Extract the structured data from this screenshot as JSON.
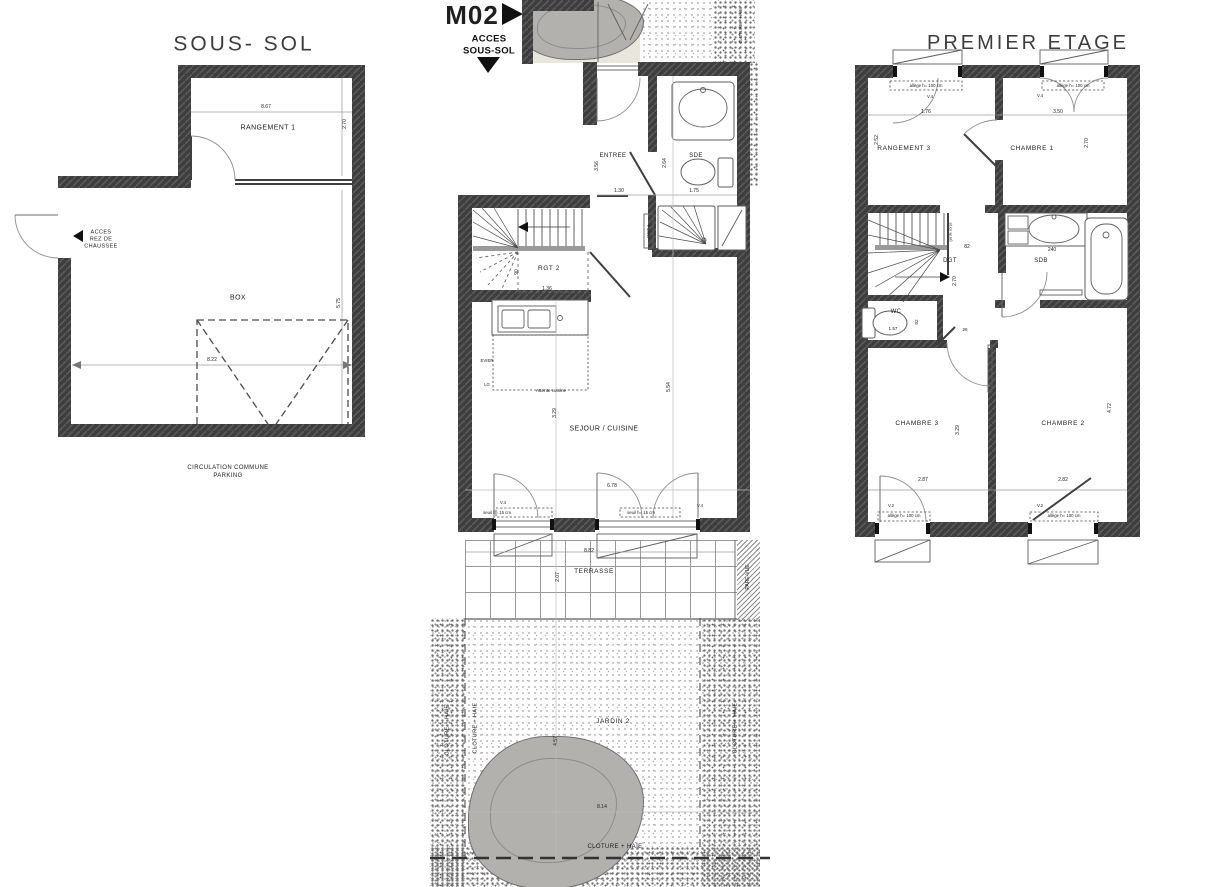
{
  "doc": {
    "type": "floor-plan",
    "unit": "M02"
  },
  "sous_sol": {
    "title": "SOUS- SOL",
    "rangement1": "RANGEMENT 1",
    "box": "BOX",
    "acces": "ACCES\nREZ DE\nCHAUSSEE",
    "circulation": "CIRCULATION COMMUNE\nPARKING",
    "dims": {
      "w_rangement": "8.67",
      "h_rangement": "2.70",
      "w_box": "8.22",
      "h_box": "5.75"
    }
  },
  "rdc": {
    "marker": "M02",
    "acces": "ACCES\nSOUS-SOL",
    "rooms": {
      "entree": "ENTREE",
      "sde": "SDE",
      "rgt1": "RGT 1",
      "rgt2": "RGT 2",
      "sejour": "SEJOUR / CUISINE",
      "terrasse": "TERRASSE",
      "jardin": "JARDIN 2"
    },
    "annotations": {
      "attente": "Attente cuisine",
      "evier": "EVIER",
      "lg": "LG",
      "seuil": "seuil h= 15 cm",
      "v4": "V.4",
      "pare_vue": "PARE-VUE",
      "cloture": "CLOTURE + HAIE"
    },
    "dims": {
      "entree_w": "1.30",
      "sde_w": "1.75",
      "entree_h": "3.56",
      "sde_h": "2.64",
      "rgt2_h": "90",
      "rgt2_w": "1.36",
      "sejour_h1": "3.29",
      "sejour_h2": "5.54",
      "sejour_w": "6.78",
      "terrasse_w": "8.82",
      "terrasse_h": "2.07",
      "jardin_w": "8.14",
      "jardin_h": "4.57"
    }
  },
  "etage": {
    "title": "PREMIER ETAGE",
    "rooms": {
      "rangement3": "RANGEMENT 3",
      "chambre1": "CHAMBRE 1",
      "chambre2": "CHAMBRE 2",
      "chambre3": "CHAMBRE 3",
      "dgt": "DGT",
      "sdb": "SDB",
      "wc": "WC"
    },
    "annotations": {
      "allege": "allège h= 100 cm",
      "v4": "V.4",
      "v2": "V.2",
      "garde": "garde corps"
    },
    "dims": {
      "d176": "1.76",
      "d350": "3.50",
      "d252": "2.52",
      "d270": "2.70",
      "d82": "82",
      "d240": "240",
      "d157": "1.57",
      "d92": "92",
      "d26": "26",
      "d329": "3.29",
      "d472": "4.72",
      "d287": "2.87",
      "d282": "2.82"
    }
  }
}
